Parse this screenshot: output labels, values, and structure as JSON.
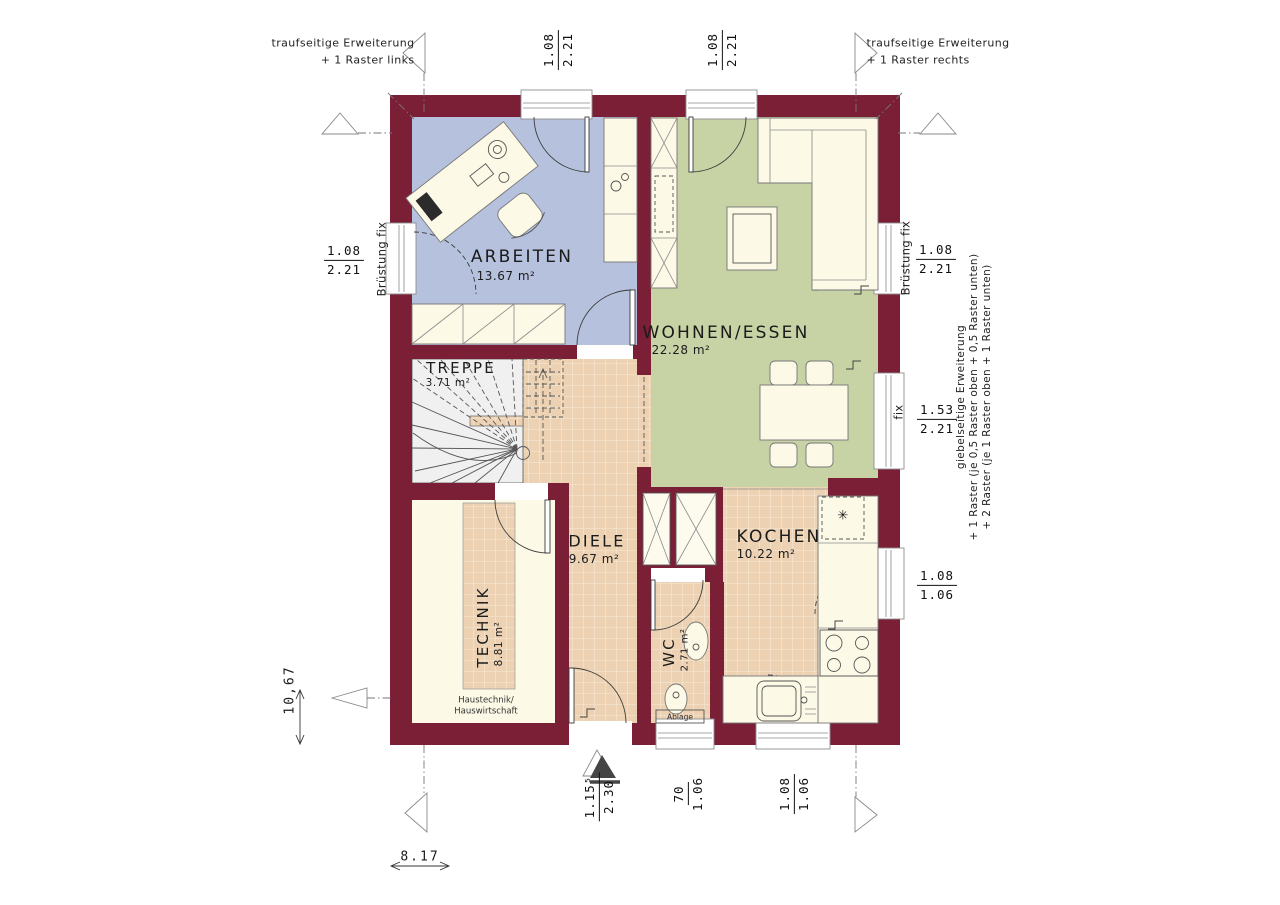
{
  "colors": {
    "wall": "#7b1f37",
    "arbeiten_floor": "#b6c1dd",
    "wohnen_floor": "#c7d2a5",
    "tile_floor": "#ecd2b2",
    "tile_grout": "#f7ead7",
    "furniture": "#fcf9e6",
    "stair": "#f0f0f0"
  },
  "rooms": {
    "arbeiten": {
      "name": "ARBEITEN",
      "area": "13.67 m²"
    },
    "wohnen": {
      "name": "WOHNEN/ESSEN",
      "area": "22.28 m²"
    },
    "treppe": {
      "name": "TREPPE",
      "area": "3.71 m²"
    },
    "diele": {
      "name": "DIELE",
      "area": "9.67 m²"
    },
    "kochen": {
      "name": "KOCHEN",
      "area": "10.22 m²"
    },
    "wc": {
      "name": "WC",
      "area": "2.71 m²"
    },
    "technik": {
      "name": "TECHNIK",
      "area": "8.81 m²",
      "note_line1": "Haustechnik/",
      "note_line2": "Hauswirtschaft"
    }
  },
  "annotations": {
    "trauf_left_line1": "traufseitige Erweiterung",
    "trauf_left_line2": "+ 1 Raster links",
    "trauf_right_line1": "traufseitige Erweiterung",
    "trauf_right_line2": "+ 1 Raster rechts",
    "giebel_line1": "giebelseitige Erweiterung",
    "giebel_line2": "+ 1 Raster (je 0,5 Raster oben + 0,5 Raster unten)",
    "giebel_line3": "+ 2 Raster (je 1 Raster oben + 1 Raster unten)",
    "brustung_left": "Brüstung fix",
    "brustung_right": "Brüstung fix",
    "fix_right": "fix",
    "ablage": "Ablage",
    "freezer_symbol": "✳"
  },
  "dimensions": {
    "top_window_left": {
      "num": "1.08",
      "den": "2.21"
    },
    "top_window_right": {
      "num": "1.08",
      "den": "2.21"
    },
    "left_window": {
      "num": "1.08",
      "den": "2.21"
    },
    "right_window_top": {
      "num": "1.08",
      "den": "2.21"
    },
    "right_window_mid": {
      "num": "1.53",
      "den": "2.21"
    },
    "right_window_bottom": {
      "num": "1.08",
      "den": "1.06"
    },
    "bottom_entrance": {
      "num": "1.15⁵",
      "den": "2.30"
    },
    "bottom_wc_window": {
      "num": "70",
      "den": "1.06"
    },
    "bottom_kitchen_window": {
      "num": "1.08",
      "den": "1.06"
    },
    "overall_width": "8.17",
    "overall_height": "10,67"
  }
}
